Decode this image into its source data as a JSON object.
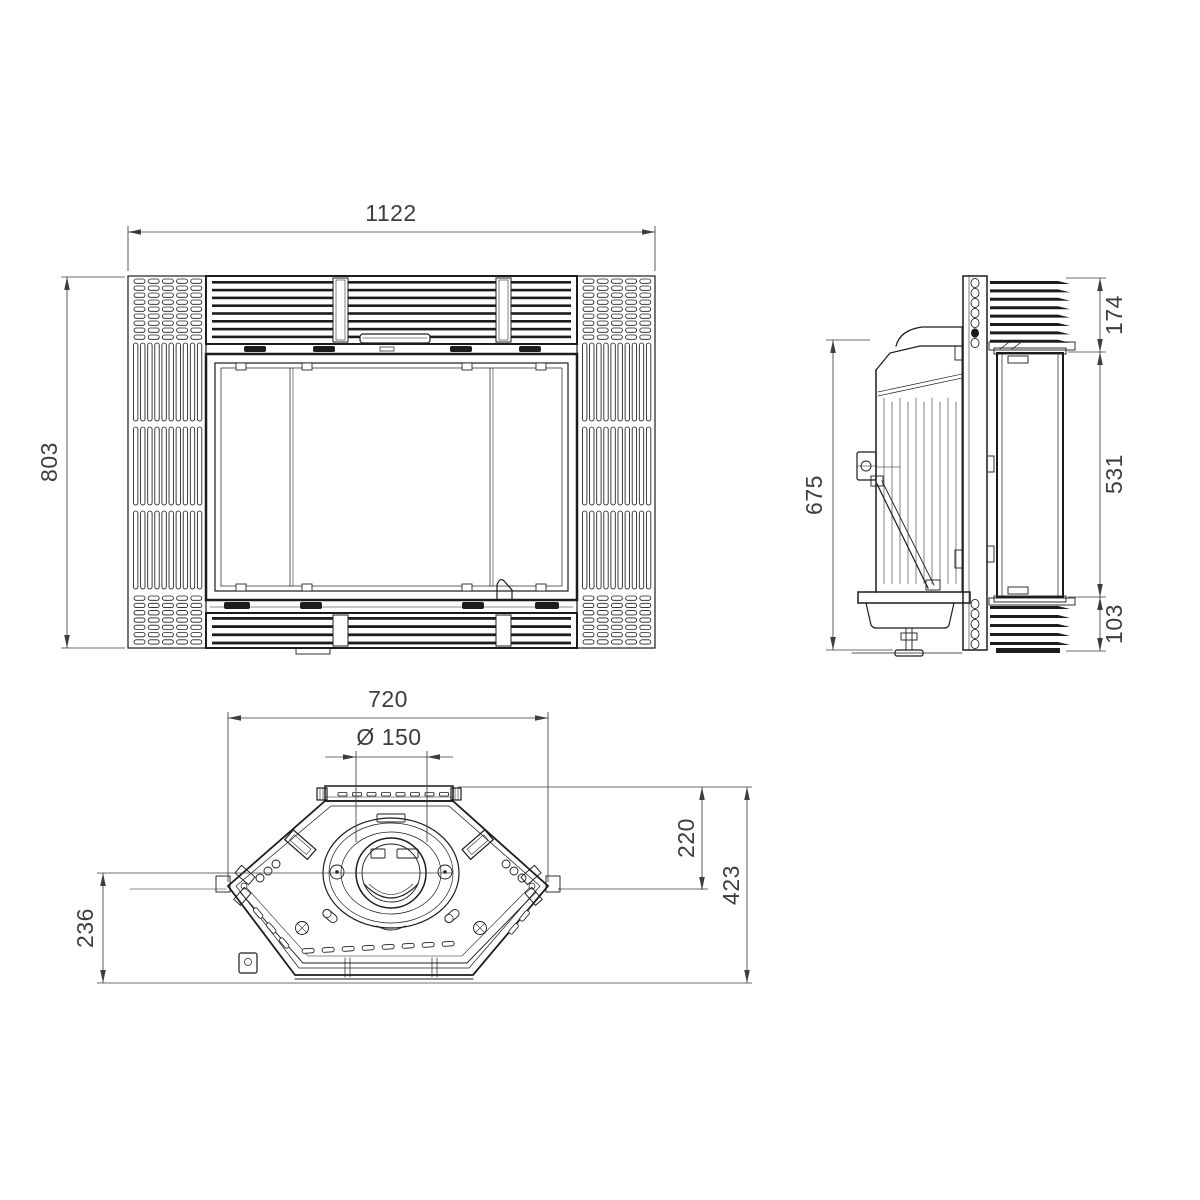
{
  "drawing": {
    "background": "#ffffff",
    "line_color": "#1c1c1c",
    "dim_color": "#3d3d3d"
  },
  "dimensions": {
    "front_width": "1122",
    "front_height": "803",
    "side_height": "675",
    "side_top_grille": "174",
    "side_door": "531",
    "side_bottom_grille": "103",
    "plan_width": "720",
    "flue_diameter": "Ø 150",
    "plan_rear_to_center": "220",
    "plan_depth": "423",
    "plan_front": "236"
  }
}
